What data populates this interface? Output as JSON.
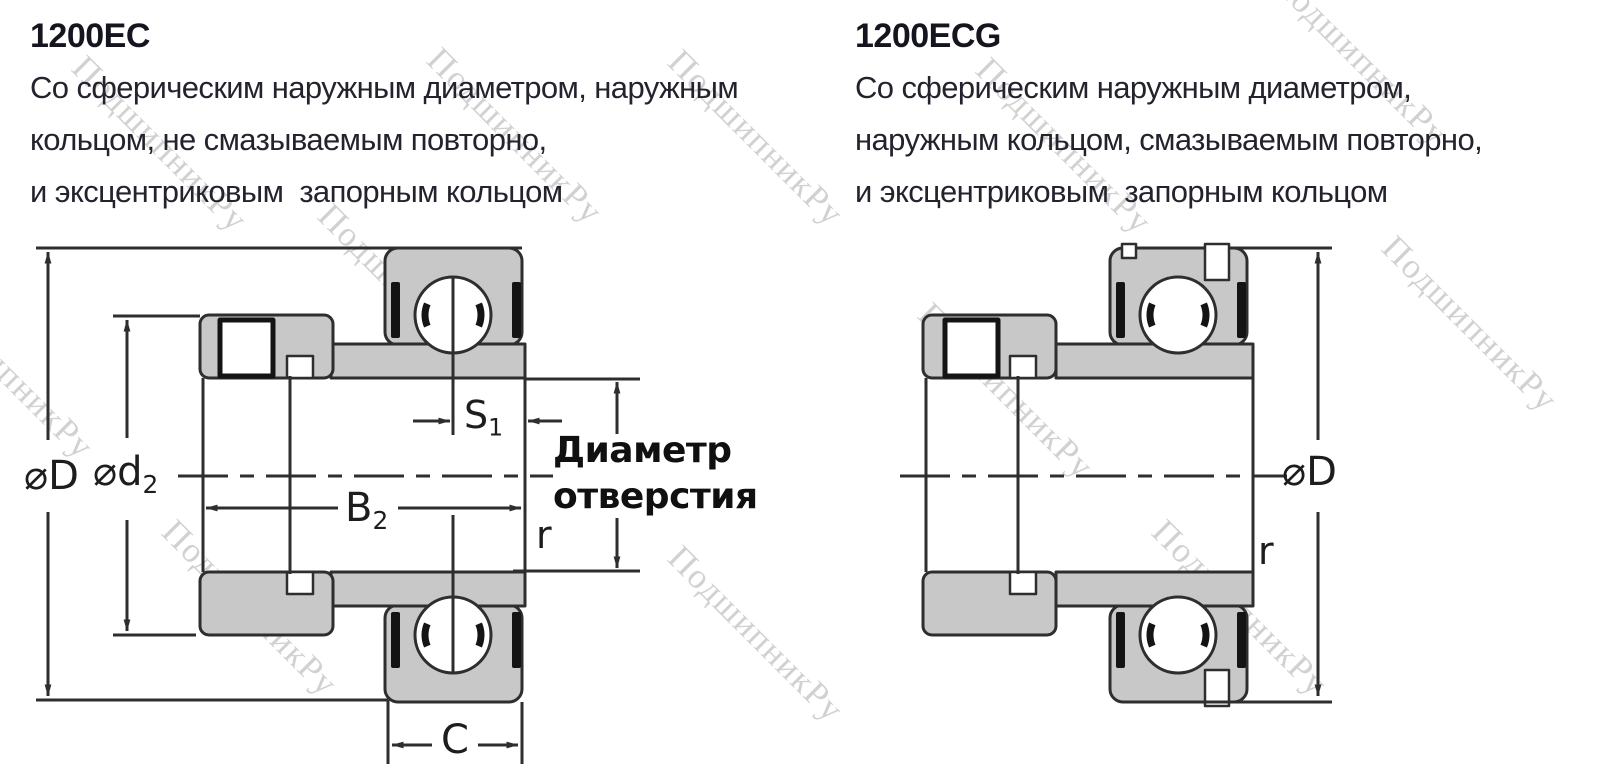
{
  "watermark": {
    "text": "ПодшипникРу",
    "color": "#c9c9c9"
  },
  "left": {
    "title": "1200EC",
    "description_lines": [
      "Со сферическим наружным диаметром, наружным",
      "кольцом, не смазываемым повторно,",
      "и эксцентриковым  запорным кольцом"
    ],
    "labels": {
      "outer_diameter": {
        "base": "⌀D",
        "sub": ""
      },
      "collar_diameter": {
        "base": "⌀d",
        "sub": "2"
      },
      "s1": {
        "base": "S",
        "sub": "1"
      },
      "b2": {
        "base": "B",
        "sub": "2"
      },
      "bore_diameter_line1": "Диаметр",
      "bore_diameter_line2": "отверстия",
      "fillet_radius": "r",
      "outer_ring_width": "C"
    }
  },
  "right": {
    "title": "1200ECG",
    "description_lines": [
      "Со сферическим наружным диаметром,",
      "наружным кольцом, смазываемым повторно,",
      "и эксцентриковым  запорным кольцом"
    ],
    "labels": {
      "outer_diameter": {
        "base": "⌀D",
        "sub": ""
      },
      "fillet_radius": "r"
    }
  },
  "drawing_colors": {
    "metal_fill": "#c8c8c8",
    "line": "#2e2e2e",
    "seal": "#141414"
  }
}
